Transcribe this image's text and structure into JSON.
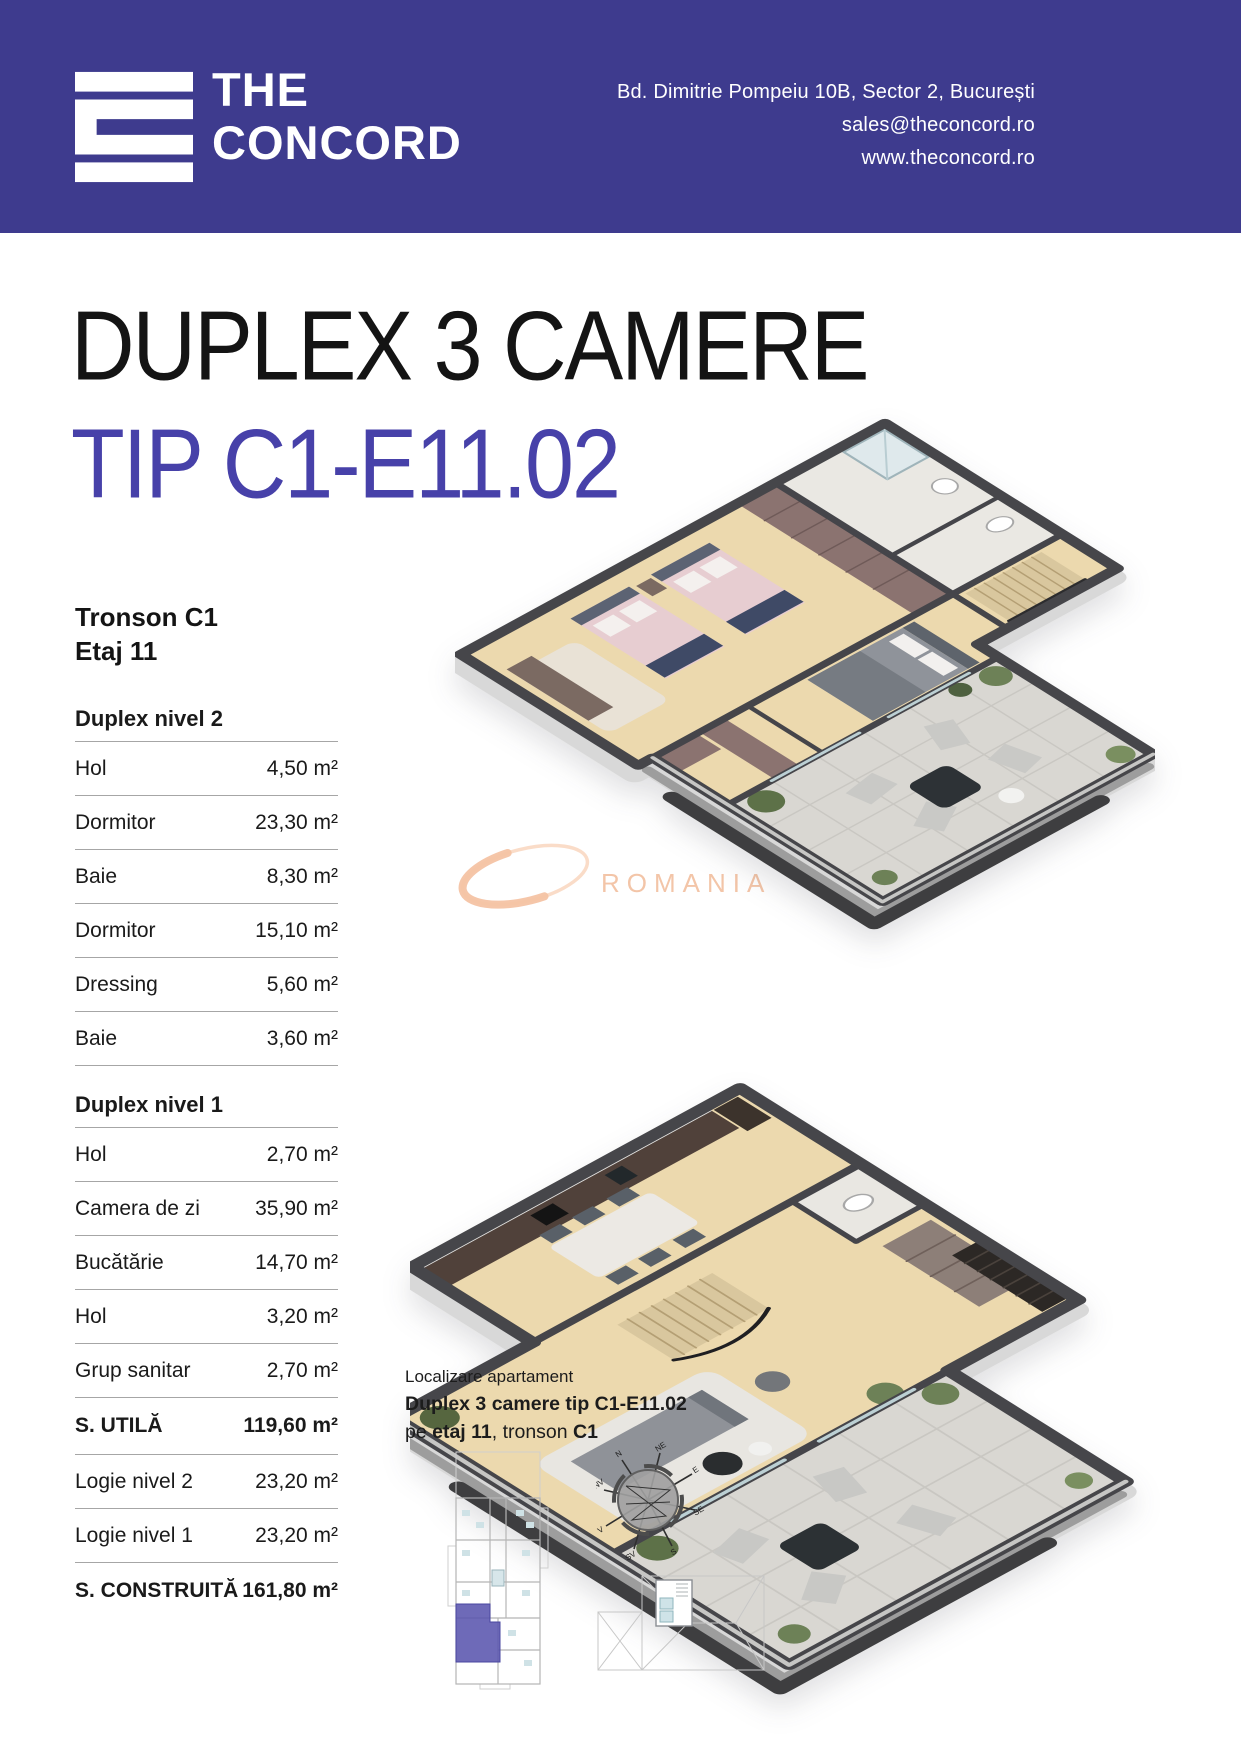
{
  "header": {
    "brand_line1": "THE",
    "brand_line2": "CONCORD",
    "address": "Bd. Dimitrie Pompeiu 10B, Sector 2, București",
    "email": "sales@theconcord.ro",
    "website": "www.theconcord.ro",
    "brand_color": "#3e3b8e"
  },
  "title": {
    "line1": "DUPLEX 3 CAMERE",
    "line2": "TIP C1-E11.02",
    "accent_color": "#4741a9"
  },
  "location_block": {
    "tronson": "Tronson C1",
    "etaj": "Etaj 11"
  },
  "table": {
    "rows": [
      {
        "type": "section",
        "label": "Duplex nivel 2",
        "value": ""
      },
      {
        "type": "item",
        "label": "Hol",
        "value": "4,50 m²"
      },
      {
        "type": "item",
        "label": "Dormitor",
        "value": "23,30 m²"
      },
      {
        "type": "item",
        "label": "Baie",
        "value": "8,30 m²"
      },
      {
        "type": "item",
        "label": "Dormitor",
        "value": "15,10 m²"
      },
      {
        "type": "item",
        "label": "Dressing",
        "value": "5,60 m²"
      },
      {
        "type": "item",
        "label": "Baie",
        "value": "3,60 m²"
      },
      {
        "type": "section",
        "label": "Duplex nivel 1",
        "value": ""
      },
      {
        "type": "item",
        "label": "Hol",
        "value": "2,70 m²"
      },
      {
        "type": "item",
        "label": "Camera de zi",
        "value": "35,90 m²"
      },
      {
        "type": "item",
        "label": "Bucătărie",
        "value": "14,70 m²"
      },
      {
        "type": "item",
        "label": "Hol",
        "value": "3,20 m²"
      },
      {
        "type": "item",
        "label": "Grup sanitar",
        "value": "2,70 m²"
      },
      {
        "type": "total",
        "label": "S. UTILĂ",
        "value": "119,60 m²"
      },
      {
        "type": "item",
        "label": "Logie nivel 2",
        "value": "23,20 m²"
      },
      {
        "type": "item",
        "label": "Logie nivel 1",
        "value": "23,20 m²"
      },
      {
        "type": "total",
        "label": "S. CONSTRUITĂ",
        "value": "161,80 m²"
      }
    ]
  },
  "localizare": {
    "line1": "Localizare apartament",
    "line2": "Duplex 3 camere tip C1-E11.02",
    "line3_pre": "pe ",
    "line3_bold1": "etaj 11",
    "line3_mid": ", tronson ",
    "line3_bold2": "C1"
  },
  "watermark": {
    "text": "ROMANIA",
    "color": "#f3c5a8"
  },
  "compass": {
    "labels": [
      "N",
      "NE",
      "E",
      "SE",
      "S",
      "SV",
      "V",
      "NV"
    ]
  },
  "keyplan": {
    "highlight_color": "#5a55ae"
  }
}
